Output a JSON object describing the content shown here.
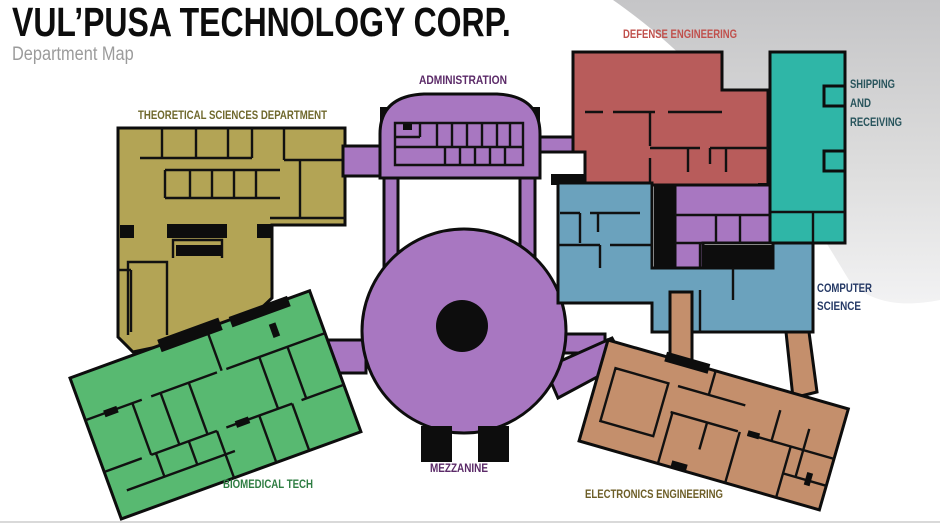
{
  "header": {
    "title": "VUL’PUSA TECHNOLOGY CORP.",
    "subtitle": "Department Map"
  },
  "departments": {
    "theoretical": {
      "label": "THEORETICAL SCIENCES DEPARTMENT",
      "color": "#b3a455",
      "label_color": "#6f682c"
    },
    "administration": {
      "label": "ADMINISTRATION",
      "color": "#a877c1",
      "label_color": "#5b2a68"
    },
    "defense": {
      "label": "DEFENSE ENGINEERING",
      "color": "#b85c5b",
      "label_color": "#c0504c"
    },
    "shipping": {
      "label": "SHIPPING AND RECEIVING",
      "lines": [
        "SHIPPING",
        "AND",
        "RECEIVING"
      ],
      "color": "#2fb6a7",
      "label_color": "#28545c"
    },
    "computer": {
      "label": "COMPUTER SCIENCE",
      "lines": [
        "COMPUTER",
        "SCIENCE"
      ],
      "color": "#6ba2bd",
      "label_color": "#263a66"
    },
    "mezzanine": {
      "label": "MEZZANINE",
      "color": "#a877c1",
      "label_color": "#5b2a68"
    },
    "electronics": {
      "label": "ELECTRONICS ENGINEERING",
      "color": "#c48f6c",
      "label_color": "#6d5e27"
    },
    "biomedical": {
      "label": "BIOMEDICAL TECH",
      "color": "#58b971",
      "label_color": "#2e7d42"
    }
  },
  "canvas": {
    "background": "#ffffff",
    "wall_color": "#0d0d0d",
    "blob_gray_top": "#c5c5c7",
    "blob_gray_mid": "#dddddd",
    "blob_gray_bottom": "#f2f2f3",
    "divider_color": "#d9d9d9"
  }
}
